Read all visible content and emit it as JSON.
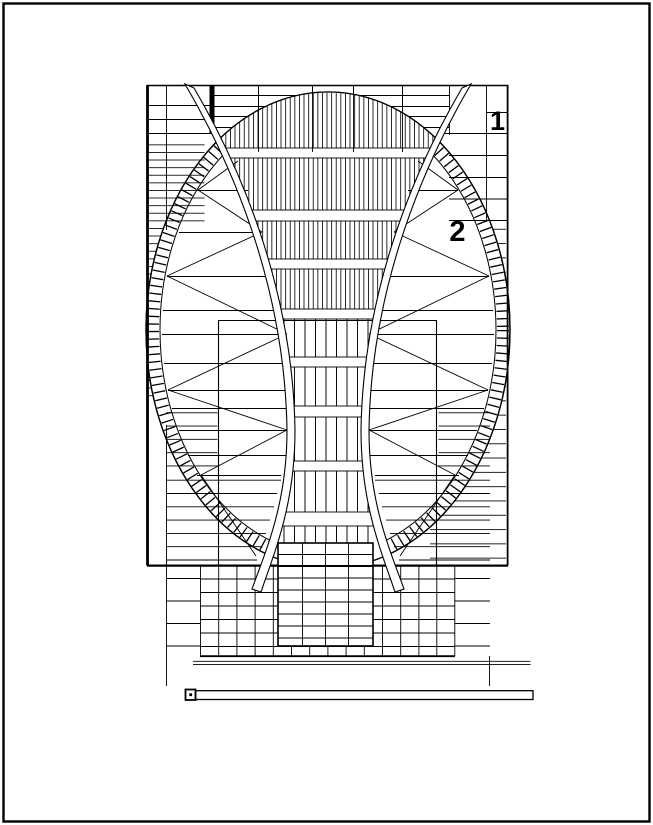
{
  "page": {
    "background": "#ffffff",
    "ink": "#000000"
  },
  "drawing": {
    "type": "cad-structural-plan",
    "description": "elliptical roof plan with two curved sail beams, hatched ring, trusses, podium grid and scale bar",
    "labels": {
      "zone1": "1",
      "zone2": "2"
    }
  }
}
